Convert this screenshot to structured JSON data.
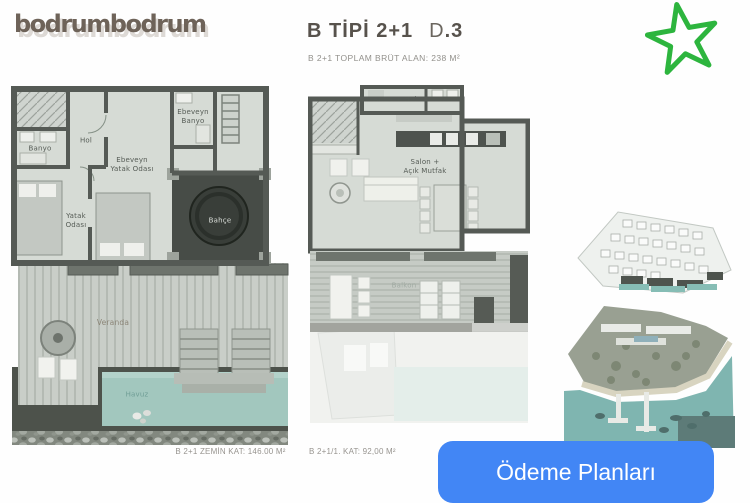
{
  "header": {
    "logo": "bodrumbodrum",
    "title": "B TİPİ 2+1",
    "unit_prefix": "D",
    "unit_number": ".3",
    "subtitle": "B 2+1 TOPLAM BRÜT ALAN: 238 M²"
  },
  "icons": {
    "favorite_star": "star-outline",
    "favorite_star_color": "#2db53e"
  },
  "plans": {
    "ground": {
      "caption": "B 2+1 ZEMİN KAT: 146.00 M²",
      "rooms": {
        "banyo": "Banyo",
        "hol": "Hol",
        "ebeveyn_banyo": "Ebeveyn\nBanyo",
        "ebeveyn_yatak_odasi": "Ebeveyn\nYatak Odası",
        "yatak_odasi": "Yatak\nOdası",
        "bahce": "Bahçe",
        "veranda": "Veranda",
        "havuz": "Havuz"
      }
    },
    "first": {
      "caption": "B 2+1/1. KAT: 92,00 M²",
      "rooms": {
        "antre_hol": "Antre + Hol",
        "wc": "WC",
        "salon_acik_mutfak": "Salon +\nAçık Mutfak",
        "balkon": "Balkon"
      }
    }
  },
  "thumbnails": {
    "site_plan": "site-plan-3d-render",
    "aerial_view": "aerial-beach-photo"
  },
  "cta": {
    "label": "Ödeme Planları",
    "color": "#4286f5"
  }
}
